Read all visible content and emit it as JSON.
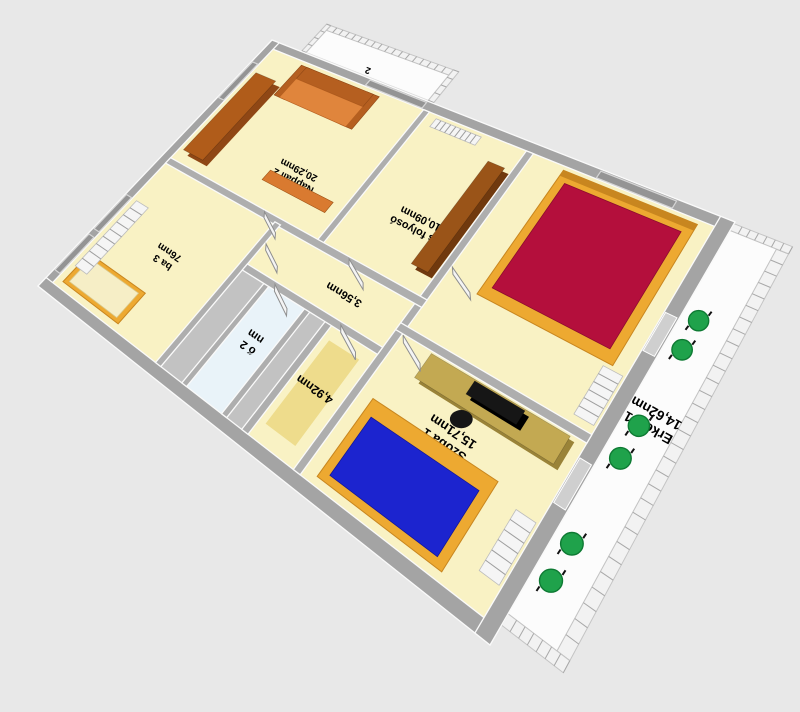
{
  "scene": {
    "title": "3D floor plan view",
    "background": "#e8e8e8",
    "unit_suffix": "nm"
  },
  "colors": {
    "floor": "#f9f2c4",
    "bath_floor": "#e9f3f9",
    "hall_floor": "#c2c2c2",
    "wall": "#aeaeae",
    "wall_ext": "#a4a4a4",
    "wall_top": "#fafafa",
    "balcony_floor": "#fcfcfc",
    "railing_bg": "#f2f2f2",
    "railing_tick": "#a8a8a8",
    "door": "#f4f4f4",
    "door_edge": "#8f8f8f",
    "window_pane": "#949494",
    "window_frame": "#d6d6d6",
    "bed_frame": "#eda931",
    "bed_frame_dark": "#c8861f",
    "bed2_mattress": "#b40f3c",
    "bed1_mattress": "#1c24cf",
    "bed3_mattress": "#f6eec6",
    "sofa_seat": "#e0853c",
    "sofa_back": "#b55f20",
    "wardrobe": "#b05c1a",
    "wardrobe_side": "#8f4715",
    "counter": "#9a5418",
    "counter_side": "#70390e",
    "desk": "#c3a952",
    "desk_side": "#9a8338",
    "tv": "#161616",
    "chair_green": "#1fa24b",
    "chair_green_dark": "#0e7a33",
    "rug": "#eedc8c",
    "radiator": "#f5f5f5",
    "radiator_rib": "#9e9e9e",
    "shelf": "#d97a30",
    "text": "#000000"
  },
  "labels": {
    "nappali": {
      "name": "Nappali 2",
      "area": "20,29nm"
    },
    "folyoso": {
      "name": "és folyosó",
      "area": "10,09nm"
    },
    "szoba2": {
      "name": "Szoba 2",
      "area": "15,79nm"
    },
    "szoba1": {
      "name": "Szoba 1",
      "area": "15,71nm"
    },
    "szoba3": {
      "name": "ba 3",
      "area": "76nm"
    },
    "furdo": {
      "name": "ő 2",
      "area": "nm"
    },
    "r356": {
      "area": "3,56nm"
    },
    "r492": {
      "area": "4,92nm"
    },
    "erkely1": {
      "name": "Erkély 1",
      "area": "14,62nm"
    },
    "erkely2": {
      "fragment": "2"
    }
  }
}
